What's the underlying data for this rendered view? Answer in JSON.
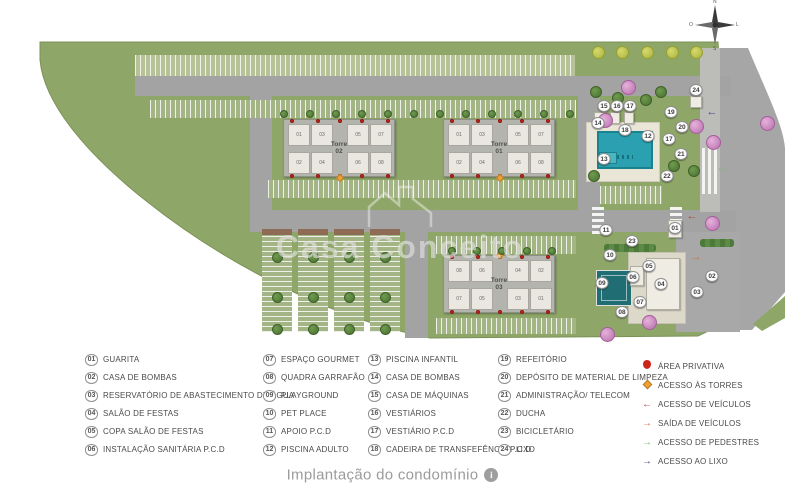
{
  "caption": {
    "title": "Implantação do condomínio",
    "info_icon": "i"
  },
  "watermark": {
    "text": "Casa Conceito"
  },
  "compass": {
    "n": "N",
    "s": "S",
    "e": "L",
    "w": "O"
  },
  "plan": {
    "towers": [
      {
        "label_line1": "Torre",
        "label_line2": "02",
        "x": 283,
        "y": 119,
        "w": 112,
        "h": 58,
        "units_top": [
          "01",
          "03",
          "05",
          "07"
        ],
        "units_bottom": [
          "02",
          "04",
          "06",
          "08"
        ],
        "entrance": "bottom"
      },
      {
        "label_line1": "Torre",
        "label_line2": "01",
        "x": 443,
        "y": 119,
        "w": 112,
        "h": 58,
        "units_top": [
          "01",
          "03",
          "05",
          "07"
        ],
        "units_bottom": [
          "02",
          "04",
          "06",
          "08"
        ],
        "entrance": "bottom"
      },
      {
        "label_line1": "Torre",
        "label_line2": "03",
        "x": 443,
        "y": 255,
        "w": 112,
        "h": 58,
        "units_top": [
          "08",
          "06",
          "04",
          "02"
        ],
        "units_bottom": [
          "07",
          "05",
          "03",
          "01"
        ],
        "entrance": "top"
      }
    ],
    "markers": [
      {
        "n": "15",
        "x": 604,
        "y": 106
      },
      {
        "n": "16",
        "x": 617,
        "y": 106
      },
      {
        "n": "17",
        "x": 630,
        "y": 106
      },
      {
        "n": "24",
        "x": 696,
        "y": 90
      },
      {
        "n": "14",
        "x": 598,
        "y": 123
      },
      {
        "n": "18",
        "x": 625,
        "y": 130
      },
      {
        "n": "12",
        "x": 648,
        "y": 136
      },
      {
        "n": "19",
        "x": 671,
        "y": 112
      },
      {
        "n": "20",
        "x": 682,
        "y": 127
      },
      {
        "n": "17",
        "x": 669,
        "y": 139
      },
      {
        "n": "21",
        "x": 681,
        "y": 154
      },
      {
        "n": "13",
        "x": 604,
        "y": 159
      },
      {
        "n": "22",
        "x": 667,
        "y": 176
      },
      {
        "n": "11",
        "x": 606,
        "y": 230
      },
      {
        "n": "23",
        "x": 632,
        "y": 241
      },
      {
        "n": "10",
        "x": 610,
        "y": 255
      },
      {
        "n": "01",
        "x": 675,
        "y": 228
      },
      {
        "n": "09",
        "x": 602,
        "y": 283
      },
      {
        "n": "06",
        "x": 633,
        "y": 277
      },
      {
        "n": "05",
        "x": 649,
        "y": 266
      },
      {
        "n": "04",
        "x": 661,
        "y": 284
      },
      {
        "n": "07",
        "x": 640,
        "y": 302
      },
      {
        "n": "08",
        "x": 622,
        "y": 312
      },
      {
        "n": "02",
        "x": 712,
        "y": 276
      },
      {
        "n": "03",
        "x": 697,
        "y": 292
      }
    ],
    "map_arrows": [
      {
        "glyph": "←",
        "color": "#b5443c",
        "x": 692,
        "y": 216,
        "name": "vehicle-access-arrow"
      },
      {
        "glyph": "→",
        "color": "#d96c3f",
        "x": 696,
        "y": 257,
        "name": "vehicle-exit-arrow"
      },
      {
        "glyph": "←",
        "color": "#4b3d8f",
        "x": 712,
        "y": 112,
        "name": "trash-access-arrow"
      },
      {
        "glyph": "←",
        "color": "#7cb87c",
        "x": 722,
        "y": 168,
        "name": "pedestrian-access-arrow"
      }
    ]
  },
  "legend": {
    "columns": [
      [
        {
          "num": "01",
          "label": "GUARITA"
        },
        {
          "num": "02",
          "label": "CASA DE BOMBAS"
        },
        {
          "num": "03",
          "label": "RESERVATÓRIO DE ABASTECIMENTO DE ÁGUA"
        },
        {
          "num": "04",
          "label": "SALÃO DE FESTAS"
        },
        {
          "num": "05",
          "label": "COPA SALÃO DE FESTAS"
        },
        {
          "num": "06",
          "label": "INSTALAÇÃO SANITÁRIA P.C.D"
        }
      ],
      [
        {
          "num": "07",
          "label": "ESPAÇO GOURMET"
        },
        {
          "num": "08",
          "label": "QUADRA GARRAFÃO"
        },
        {
          "num": "09",
          "label": "PLAYGROUND"
        },
        {
          "num": "10",
          "label": "PET PLACE"
        },
        {
          "num": "11",
          "label": "APOIO P.C.D"
        },
        {
          "num": "12",
          "label": "PISCINA ADULTO"
        }
      ],
      [
        {
          "num": "13",
          "label": "PISCINA INFANTIL"
        },
        {
          "num": "14",
          "label": "CASA DE BOMBAS"
        },
        {
          "num": "15",
          "label": "CASA DE MÁQUINAS"
        },
        {
          "num": "16",
          "label": "VESTIÁRIOS"
        },
        {
          "num": "17",
          "label": "VESTIÁRIO P.C.D"
        },
        {
          "num": "18",
          "label": "CADEIRA DE TRANSFEFÊNCIA P.C.D"
        }
      ],
      [
        {
          "num": "19",
          "label": "REFEITÓRIO"
        },
        {
          "num": "20",
          "label": "DEPÓSITO DE MATERIAL DE LIMPEZA"
        },
        {
          "num": "21",
          "label": "ADMINISTRAÇÃO/ TELECOM"
        },
        {
          "num": "22",
          "label": "DUCHA"
        },
        {
          "num": "23",
          "label": "BICICLETÁRIO"
        },
        {
          "num": "24",
          "label": "LIXO"
        }
      ]
    ],
    "symbols": [
      {
        "icon": "circle",
        "color": "#cc2418",
        "label": "ÁREA PRIVATIVA",
        "name": "private-area-icon"
      },
      {
        "icon": "diamond",
        "color": "#f0a030",
        "label": "ACESSO ÀS TORRES",
        "name": "tower-access-icon"
      },
      {
        "icon": "arrow-left",
        "color": "#b5443c",
        "label": "ACESSO DE VEÍCULOS",
        "name": "vehicle-access-icon"
      },
      {
        "icon": "arrow-right",
        "color": "#d96c3f",
        "label": "SAÍDA DE VEÍCULOS",
        "name": "vehicle-exit-icon"
      },
      {
        "icon": "arrow-right",
        "color": "#7cb87c",
        "label": "ACESSO DE PEDESTRES",
        "name": "pedestrian-access-icon"
      },
      {
        "icon": "arrow-right",
        "color": "#4b3d8f",
        "label": "ACESSO AO LIXO",
        "name": "trash-access-icon"
      }
    ]
  },
  "colors": {
    "grass": "#8ea768",
    "road": "#a3a3a3",
    "pool": "#2ba0b0",
    "private_area": "#cc2418",
    "tower_access": "#f0a030"
  }
}
